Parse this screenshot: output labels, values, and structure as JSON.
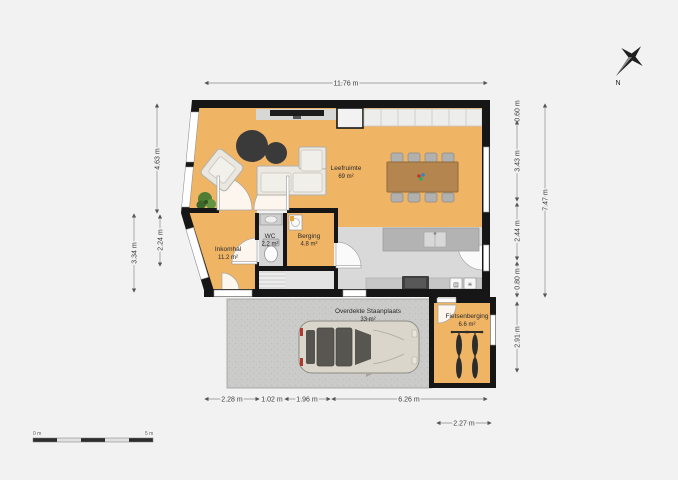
{
  "plan": {
    "type": "floorplan",
    "rooms": {
      "leefruimte": {
        "name": "Leefruimte",
        "area": "69 m²"
      },
      "wc": {
        "name": "WC",
        "area": "2.2 m²"
      },
      "berging": {
        "name": "Berging",
        "area": "4.8 m²"
      },
      "inkomhal": {
        "name": "Inkomhal",
        "area": "11.2 m²"
      },
      "carport": {
        "name": "Overdekte Staanplaats",
        "area": "33 m²"
      },
      "fietsenberging": {
        "name": "Fietsenberging",
        "area": "6.6 m²"
      }
    },
    "dimensions": {
      "top_width": "11.76 m",
      "left_upper": "4.63 m",
      "left_mid": "2.24 m",
      "left_lower": "3.34 m",
      "right_seg1": "0.60 m",
      "right_seg2": "3.43 m",
      "right_seg3": "2.44 m",
      "right_seg4": "0.80 m",
      "right_total": "7.47 m",
      "right_lower": "2.91 m",
      "bottom_seg1": "2.28 m",
      "bottom_seg2": "1.02 m",
      "bottom_seg3": "1.96 m",
      "bottom_seg4": "6.26 m",
      "bottom_right": "2.27 m"
    },
    "compass": {
      "north_label": "N"
    },
    "scale_bar": {
      "start_label": "0 m",
      "end_label": "5 m"
    },
    "icons": {
      "dishwasher": "▤",
      "extractor": "✳"
    },
    "colors": {
      "background": "#f2f2f2",
      "floor_orange": "#efb464",
      "floor_gray": "#d9d9d9",
      "wall_black": "#161616",
      "carport_gray": "#cbcbc9",
      "table_wood": "#b5854f"
    }
  }
}
